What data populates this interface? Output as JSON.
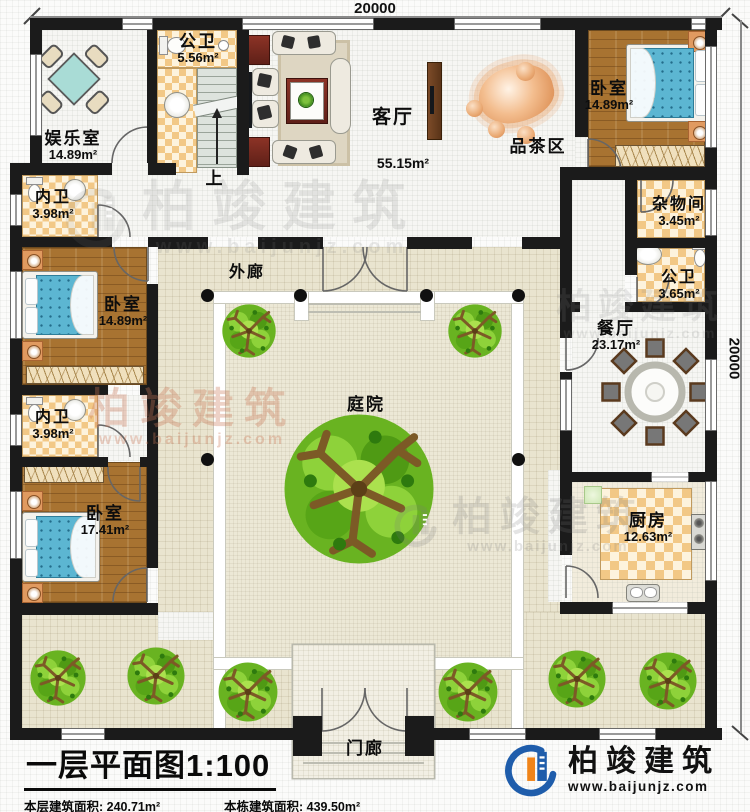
{
  "dimensions": {
    "top": "20000",
    "right": "20000"
  },
  "rooms": {
    "entertainment": {
      "label": "娱乐室",
      "area": "14.89m²"
    },
    "bath_top": {
      "label": "公卫",
      "area": "5.56m²"
    },
    "stairs": {
      "label": "上"
    },
    "living": {
      "label": "客厅",
      "area": "55.15m²"
    },
    "tea": {
      "label": "品茶区"
    },
    "bedroom_ne": {
      "label": "卧室",
      "area": "14.89m²"
    },
    "storage": {
      "label": "杂物间",
      "area": "3.45m²"
    },
    "bath_east": {
      "label": "公卫",
      "area": "3.65m²"
    },
    "dining": {
      "label": "餐厅",
      "area": "23.17m²"
    },
    "kitchen": {
      "label": "厨房",
      "area": "12.63m²"
    },
    "bath_west1": {
      "label": "内卫",
      "area": "3.98m²"
    },
    "bedroom_west": {
      "label": "卧室",
      "area": "14.89m²"
    },
    "bath_west2": {
      "label": "内卫",
      "area": "3.98m²"
    },
    "bedroom_sw": {
      "label": "卧室",
      "area": "17.41m²"
    },
    "veranda": {
      "label": "外廊"
    },
    "courtyard": {
      "label": "庭院"
    },
    "porch": {
      "label": "门廊"
    }
  },
  "titleblock": {
    "title": "一层平面图1:100",
    "stats": [
      "本层建筑面积: 240.71m²",
      "本栋建筑面积: 439.50m²",
      "占地面积: 409.66m²",
      "层高: 3.5m"
    ]
  },
  "brand": {
    "name": "柏竣建筑",
    "url": "www.baijunjz.com"
  },
  "watermark": {
    "name": "柏竣建筑",
    "url": "www.baijunjz.com"
  },
  "colors": {
    "wall": "#1b1b1b",
    "wood": "#a87331",
    "checker": "#f2c886",
    "tile": "#e9e4cf",
    "mattress": "#5cb6d2",
    "brand_blue": "#1f5dab",
    "brand_orange": "#f08419",
    "tree_green": "#66b11e"
  }
}
